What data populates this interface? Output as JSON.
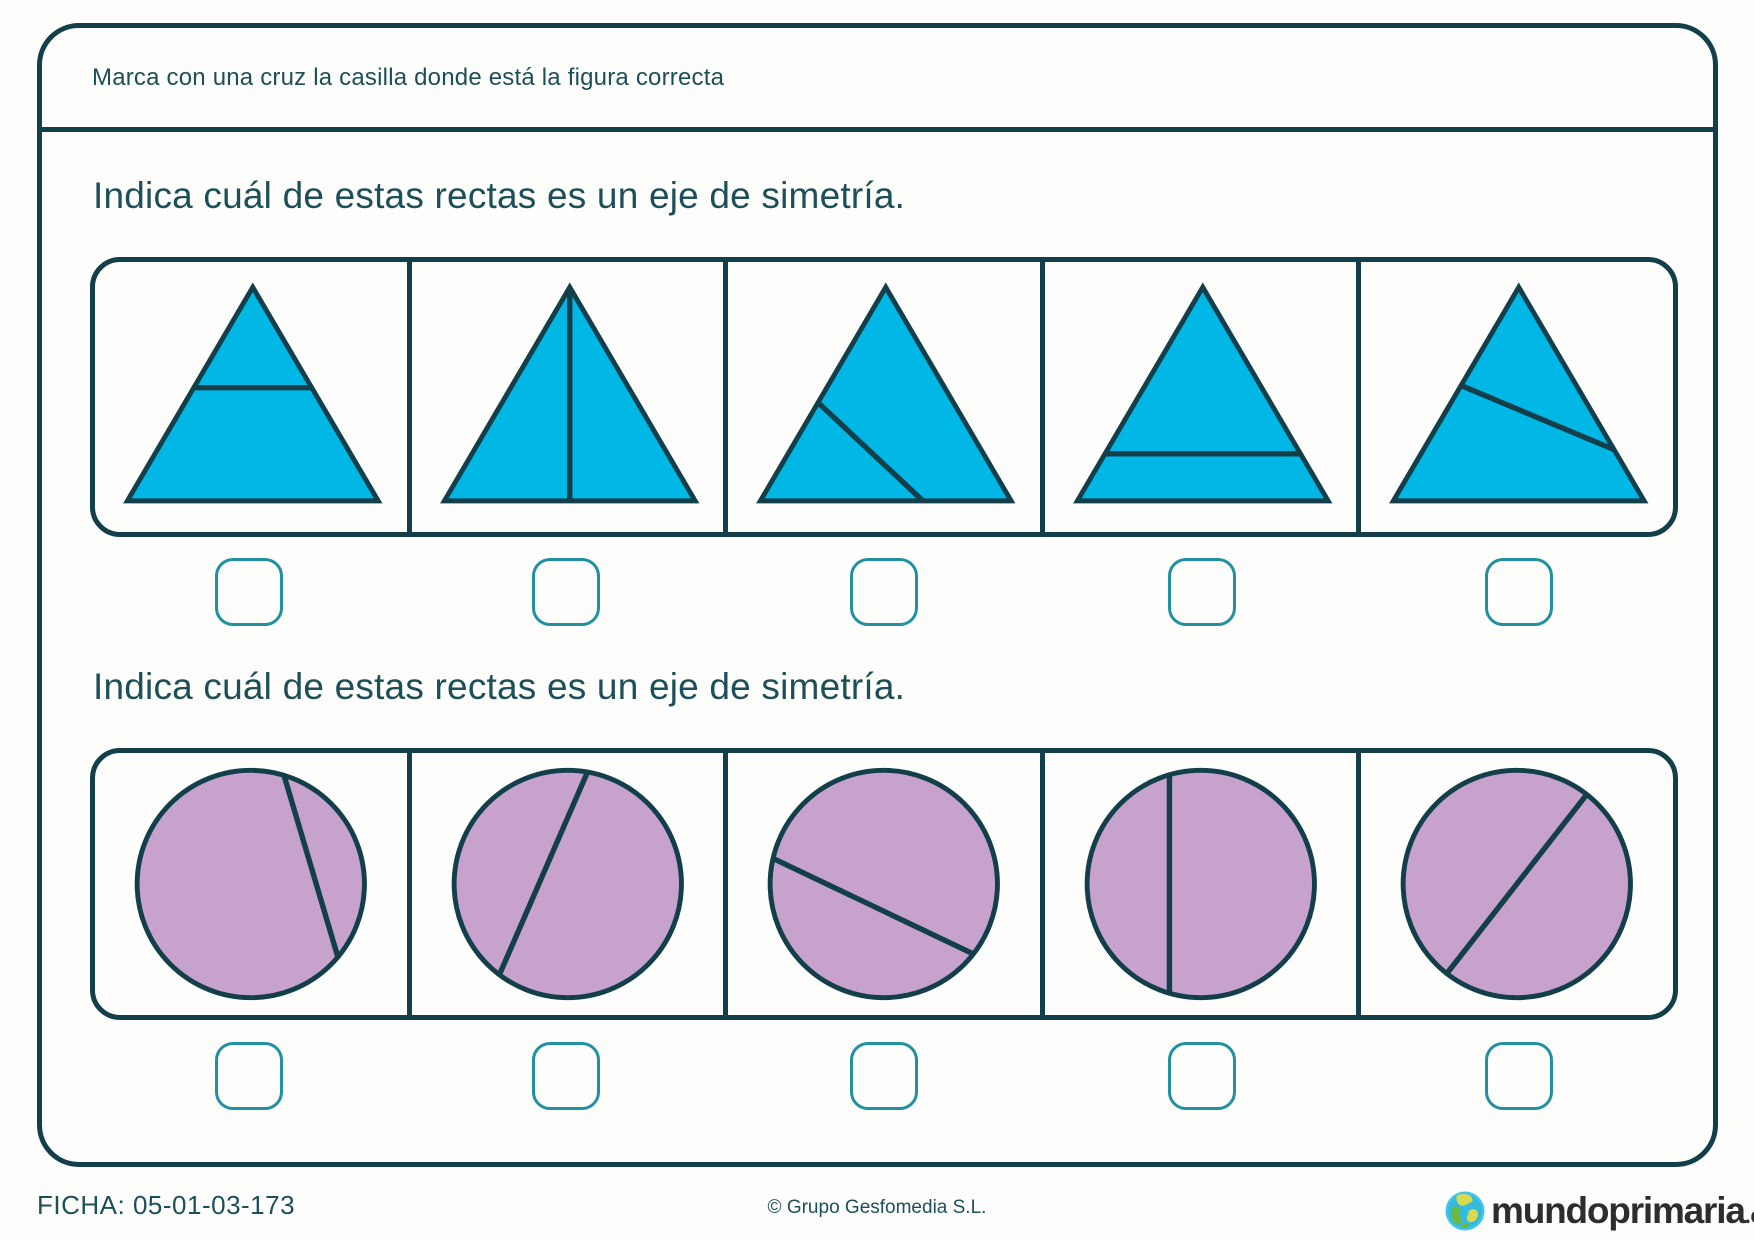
{
  "header": {
    "instruction": "Marca con una cruz la casilla donde está la figura correcta"
  },
  "sections": [
    {
      "id": "triangles",
      "title": "Indica cuál de estas rectas es un eje de simetría.",
      "shape": "triangle",
      "options": [
        {
          "name": "triangle-upper-horizontal-line",
          "line": [
            [
              100.8,
              125.5
            ],
            [
              221.2,
              125.5
            ]
          ]
        },
        {
          "name": "triangle-vertical-symmetry-axis",
          "line": [
            [
              161,
              23
            ],
            [
              161,
              241
            ]
          ]
        },
        {
          "name": "triangle-diagonal-left-to-base-line",
          "line": [
            [
              91.9,
              140.7
            ],
            [
              198.9,
              241
            ]
          ]
        },
        {
          "name": "triangle-lower-horizontal-line",
          "line": [
            [
              61.2,
              193
            ],
            [
              260.8,
              193
            ]
          ]
        },
        {
          "name": "triangle-diagonal-left-to-right-line",
          "line": [
            [
              102.1,
              123.3
            ],
            [
              258.3,
              188.7
            ]
          ]
        }
      ]
    },
    {
      "id": "circles",
      "title": "Indica cuál de estas rectas es un eje de simetría.",
      "shape": "circle",
      "options": [
        {
          "name": "circle-chord-top-to-lower-right",
          "line": [
            [
              192.9,
              20.1
            ],
            [
              247.9,
              205.6
            ]
          ]
        },
        {
          "name": "circle-chord-top-to-lower-left",
          "line": [
            [
              179.1,
              16.8
            ],
            [
              89.2,
              223.6
            ]
          ]
        },
        {
          "name": "circle-chord-left-to-lower-right",
          "line": [
            [
              46,
              104.9
            ],
            [
              250.4,
              202.4
            ]
          ]
        },
        {
          "name": "circle-vertical-off-center-chord",
          "line": [
            [
              127,
              19.5
            ],
            [
              127,
              242.5
            ]
          ]
        },
        {
          "name": "circle-diagonal-diameter-symmetry-axis",
          "line": [
            [
              230.4,
              39.6
            ],
            [
              87.6,
              222.4
            ]
          ]
        }
      ]
    }
  ],
  "footer": {
    "ficha": "FICHA: 05-01-03-173",
    "copyright": "© Grupo Gesfomedia S.L.",
    "logo_word": "mundoprimaria",
    "logo_suffix": ".com"
  },
  "colors": {
    "border_dark": "#123f4a",
    "text_teal": "#1d4f58",
    "checkbox_teal": "#2191a1",
    "triangle_fill": "#00b7e6",
    "circle_fill": "#c6a2cc",
    "logo_text": "#2d2d2d",
    "globe_cyan": "#3fc6ea",
    "globe_green": "#6db83f",
    "globe_yellow": "#d9d94e"
  }
}
